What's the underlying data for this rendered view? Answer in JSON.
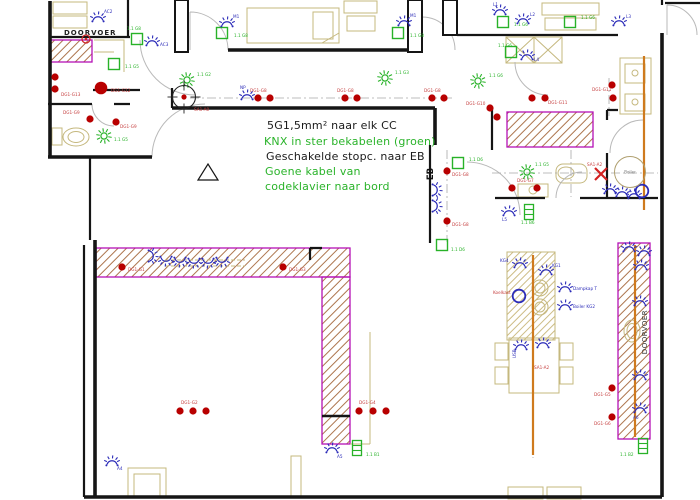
{
  "annotations": {
    "lines": [
      {
        "text": "5G1,5mm²  naar elk CC",
        "color": "#1a1a1a"
      },
      {
        "text": "KNX in ster bekabelen (groen)",
        "color": "#2ab32a"
      },
      {
        "text": "Geschakelde stopc. naar EB",
        "color": "#1a1a1a"
      },
      {
        "text": "Goene kabel van",
        "color": "#2ab32a"
      },
      {
        "text": "codeklavier naar bord",
        "color": "#2ab32a"
      }
    ]
  },
  "room_labels": [
    {
      "text": "DOORVOER"
    },
    {
      "text": "EB"
    },
    {
      "text": "DOORVOER"
    }
  ],
  "colors": {
    "wall": "#151515",
    "magenta": "#b511b5",
    "green": "#28b228",
    "blue": "#2b2bb8",
    "red": "#b80000",
    "red_label": "#c64040",
    "tan": "#c5b87e",
    "orange": "#cf7a1e",
    "grey_arc": "#b9b9b9",
    "grey_line": "#a8a8a8",
    "hatch": "#a4663a"
  },
  "sockets": [
    {
      "label": "DG1-G13",
      "lx": 61,
      "ly": 96,
      "dots": [
        [
          55,
          77
        ],
        [
          55,
          89
        ]
      ]
    },
    {
      "label": "DG1-G12",
      "lx": 111,
      "ly": 92,
      "big": true,
      "dots": [
        [
          101,
          88
        ]
      ]
    },
    {
      "label": "DG1-G9",
      "lx": 63,
      "ly": 114,
      "dots": [
        [
          90,
          119
        ]
      ]
    },
    {
      "label": "DG1-G9",
      "lx": 120,
      "ly": 128,
      "dots": [
        [
          116,
          122
        ]
      ]
    },
    {
      "label": "DG1-G8",
      "lx": 250,
      "ly": 92,
      "dots": [
        [
          258,
          98
        ],
        [
          270,
          98
        ]
      ]
    },
    {
      "label": "DG1-G8",
      "lx": 337,
      "ly": 92,
      "dots": [
        [
          345,
          98
        ],
        [
          357,
          98
        ]
      ]
    },
    {
      "label": "DG1-G8",
      "lx": 424,
      "ly": 92,
      "dots": [
        [
          432,
          98
        ],
        [
          444,
          98
        ]
      ]
    },
    {
      "label": "DG1-G11",
      "lx": 548,
      "ly": 104,
      "dots": [
        [
          532,
          98
        ],
        [
          545,
          98
        ]
      ]
    },
    {
      "label": "DG1-G10",
      "lx": 466,
      "ly": 105,
      "dots": [
        [
          490,
          108
        ],
        [
          497,
          117
        ]
      ]
    },
    {
      "label": "DG1-G11",
      "lx": 592,
      "ly": 91,
      "dots": [
        [
          612,
          85
        ],
        [
          613,
          98
        ]
      ]
    },
    {
      "label": "DG1-G7",
      "lx": 517,
      "ly": 182,
      "dots": [
        [
          512,
          188
        ],
        [
          537,
          188
        ]
      ]
    },
    {
      "label": "DG1-G8",
      "lx": 452,
      "ly": 176,
      "dots": [
        [
          447,
          171
        ]
      ]
    },
    {
      "label": "DG1-G8",
      "lx": 452,
      "ly": 226,
      "dots": [
        [
          447,
          221
        ]
      ]
    },
    {
      "label": "DG1-G1",
      "lx": 128,
      "ly": 271,
      "dots": [
        [
          122,
          267
        ]
      ]
    },
    {
      "label": "DG1-G3",
      "lx": 289,
      "ly": 271,
      "dots": [
        [
          283,
          267
        ]
      ]
    },
    {
      "label": "DG1-G2",
      "lx": 181,
      "ly": 404,
      "dots": [
        [
          180,
          411
        ],
        [
          193,
          411
        ],
        [
          206,
          411
        ]
      ]
    },
    {
      "label": "DG1-G4",
      "lx": 359,
      "ly": 404,
      "dots": [
        [
          359,
          411
        ],
        [
          373,
          411
        ],
        [
          386,
          411
        ]
      ]
    },
    {
      "label": "DG1-G5",
      "lx": 594,
      "ly": 396,
      "dots": [
        [
          612,
          388
        ]
      ]
    },
    {
      "label": "DG1-G6",
      "lx": 594,
      "ly": 425,
      "dots": [
        [
          612,
          417
        ]
      ]
    }
  ],
  "lights": [
    {
      "x": 104,
      "y": 136,
      "label": "1.1 G5",
      "lx": 114,
      "ly": 141
    },
    {
      "x": 187,
      "y": 80,
      "label": "1.1 G2",
      "lx": 197,
      "ly": 76
    },
    {
      "x": 385,
      "y": 78,
      "label": "1.1 G3",
      "lx": 395,
      "ly": 74
    },
    {
      "x": 478,
      "y": 81,
      "label": "1.1 G6",
      "lx": 489,
      "ly": 77
    },
    {
      "x": 527,
      "y": 172,
      "label": "1.1 G5",
      "lx": 535,
      "ly": 166
    }
  ],
  "switches": [
    {
      "x": 137,
      "y": 39,
      "label": "1.1 G8",
      "lx": 127,
      "ly": 30
    },
    {
      "x": 222,
      "y": 33,
      "label": "1.1 G8",
      "lx": 234,
      "ly": 37
    },
    {
      "x": 398,
      "y": 33,
      "label": "1.1 G8",
      "lx": 410,
      "ly": 37
    },
    {
      "x": 503,
      "y": 22,
      "label": "1.1 G6",
      "lx": 514,
      "ly": 26
    },
    {
      "x": 570,
      "y": 22,
      "label": "1.1 G6",
      "lx": 581,
      "ly": 19
    },
    {
      "x": 511,
      "y": 52,
      "label": "1.1 G6",
      "lx": 498,
      "ly": 47
    },
    {
      "x": 458,
      "y": 163,
      "label": "1.1 D6",
      "lx": 469,
      "ly": 161
    },
    {
      "x": 442,
      "y": 245,
      "label": "1.1 D6",
      "lx": 451,
      "ly": 251
    },
    {
      "x": 114,
      "y": 64,
      "label": "1.1 G5",
      "lx": 125,
      "ly": 68
    }
  ],
  "fixtures": [
    {
      "x": 98,
      "y": 18,
      "label": "AC2",
      "lx": 104,
      "ly": 13
    },
    {
      "x": 152,
      "y": 42,
      "label": "AC3",
      "lx": 160,
      "ly": 46
    },
    {
      "x": 247,
      "y": 96,
      "label": "NP",
      "lx": 240,
      "ly": 89
    },
    {
      "x": 227,
      "y": 23,
      "label": "M1",
      "lx": 233,
      "ly": 18
    },
    {
      "x": 404,
      "y": 22,
      "label": "M1",
      "lx": 410,
      "ly": 17
    },
    {
      "x": 500,
      "y": 11,
      "label": "L1",
      "lx": 493,
      "ly": 6
    },
    {
      "x": 523,
      "y": 20,
      "label": "L2",
      "lx": 530,
      "ly": 16
    },
    {
      "x": 619,
      "y": 22,
      "label": "L3",
      "lx": 626,
      "ly": 18
    },
    {
      "x": 527,
      "y": 56,
      "label": "L4",
      "lx": 534,
      "ly": 61
    },
    {
      "x": 509,
      "y": 212,
      "label": "L5",
      "lx": 502,
      "ly": 221
    },
    {
      "x": 436,
      "y": 190,
      "rot": 90
    },
    {
      "x": 436,
      "y": 206,
      "rot": 90
    },
    {
      "x": 152,
      "y": 256,
      "rot": 90
    },
    {
      "x": 166,
      "y": 260,
      "rot": 180
    },
    {
      "x": 180,
      "y": 261,
      "rot": 180
    },
    {
      "x": 194,
      "y": 262,
      "rot": 180
    },
    {
      "x": 208,
      "y": 262,
      "rot": 180
    },
    {
      "x": 222,
      "y": 261,
      "rot": 180
    },
    {
      "x": 112,
      "y": 462,
      "label": "A4",
      "lx": 117,
      "ly": 470
    },
    {
      "x": 332,
      "y": 449,
      "label": "A5",
      "lx": 337,
      "ly": 458
    },
    {
      "x": 640,
      "y": 409,
      "label": "A6",
      "lx": 633,
      "ly": 419
    },
    {
      "x": 629,
      "y": 248
    },
    {
      "x": 644,
      "y": 252
    },
    {
      "x": 641,
      "y": 266
    },
    {
      "x": 640,
      "y": 302
    },
    {
      "x": 640,
      "y": 376
    },
    {
      "x": 520,
      "y": 264,
      "label": "KG4",
      "lx": 500,
      "ly": 262
    },
    {
      "x": 546,
      "y": 271,
      "label": "KG1",
      "lx": 552,
      "ly": 267
    },
    {
      "x": 565,
      "y": 288,
      "label": "Dampkap T",
      "lx": 573,
      "ly": 290
    },
    {
      "x": 565,
      "y": 306,
      "label": "Boiler KG2",
      "lx": 573,
      "ly": 308
    },
    {
      "x": 521,
      "y": 346,
      "label": "USB",
      "lx": 516,
      "ly": 358,
      "lrot": -90
    },
    {
      "x": 543,
      "y": 344
    },
    {
      "x": 610,
      "y": 190
    },
    {
      "x": 622,
      "y": 193
    },
    {
      "x": 634,
      "y": 195
    }
  ],
  "radiators": [
    {
      "x": 529,
      "y": 212,
      "label": "1.1 B6",
      "lx": 521,
      "ly": 224
    },
    {
      "x": 357,
      "y": 448,
      "label": "1.1 B1",
      "lx": 366,
      "ly": 456
    },
    {
      "x": 643,
      "y": 446,
      "label": "1.1 B2",
      "lx": 620,
      "ly": 456
    }
  ],
  "rings": [
    {
      "x": 642,
      "y": 191
    },
    {
      "x": 519,
      "y": 296,
      "label": "Koelkast",
      "lx": 493,
      "ly": 294
    }
  ],
  "specials": {
    "junction": {
      "x": 184,
      "y": 97,
      "label": "SA1-A0",
      "lx": 194,
      "ly": 111
    },
    "cross": {
      "x": 601,
      "y": 174,
      "label": "SA1-A2",
      "lx": 587,
      "ly": 166
    },
    "boiler": {
      "x": 630,
      "y": 172,
      "label": "Boiler"
    },
    "table_ref": {
      "x": 534,
      "y": 369,
      "label": "SA1-A2"
    },
    "detector": {
      "x": 86,
      "y": 39
    }
  }
}
